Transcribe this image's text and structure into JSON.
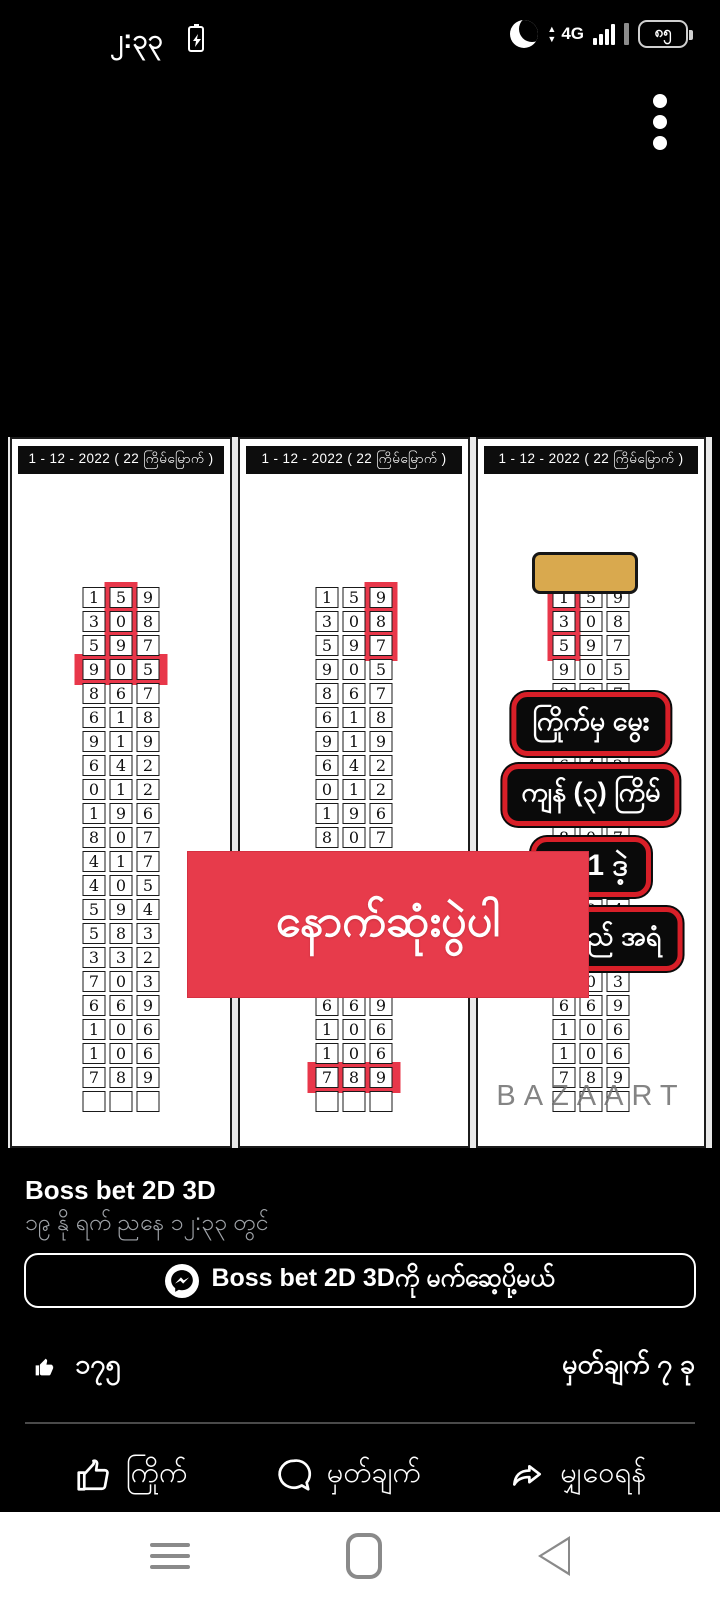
{
  "status_bar": {
    "time": "၂:၃၃",
    "network": "4G",
    "battery_percent": "၈၅",
    "charge_bolt": "⚡",
    "arrow_up": "▲",
    "arrow_down": "▼"
  },
  "lottery_image": {
    "banner_text": "နောက်ဆုံးပွဲပါ",
    "panel_header": "1 - 12 - 2022 ( 22 ကြိမ်မြောက် )",
    "watermark": "BAZAART",
    "badges": [
      "ကြိုက်မှ မွေး",
      "ကျန် (၃) ကြိမ်",
      "531 ဒဲ့",
      "ပတ်လည် အရံ"
    ],
    "grid_rows": [
      [
        "1",
        "5",
        "9"
      ],
      [
        "3",
        "0",
        "8"
      ],
      [
        "5",
        "9",
        "7"
      ],
      [
        "9",
        "0",
        "5"
      ],
      [
        "8",
        "6",
        "7"
      ],
      [
        "6",
        "1",
        "8"
      ],
      [
        "9",
        "1",
        "9"
      ],
      [
        "6",
        "4",
        "2"
      ],
      [
        "0",
        "1",
        "2"
      ],
      [
        "1",
        "9",
        "6"
      ],
      [
        "8",
        "0",
        "7"
      ],
      [
        "4",
        "1",
        "7"
      ],
      [
        "4",
        "0",
        "5"
      ],
      [
        "5",
        "9",
        "4"
      ],
      [
        "5",
        "8",
        "3"
      ],
      [
        "3",
        "3",
        "2"
      ],
      [
        "7",
        "0",
        "3"
      ],
      [
        "6",
        "6",
        "9"
      ],
      [
        "1",
        "0",
        "6"
      ],
      [
        "1",
        "0",
        "6"
      ],
      [
        "7",
        "8",
        "9"
      ],
      [
        "",
        "",
        ""
      ]
    ],
    "panels": [
      {
        "name": "left",
        "highlights": [
          {
            "type": "column",
            "col": 1,
            "row_start": 0,
            "row_end": 2
          },
          {
            "type": "row",
            "row": 3
          }
        ]
      },
      {
        "name": "center",
        "highlights": [
          {
            "type": "column",
            "col": 2,
            "row_start": 0,
            "row_end": 2
          },
          {
            "type": "row",
            "row": 20
          }
        ]
      },
      {
        "name": "right",
        "highlights": [
          {
            "type": "column",
            "col": 0,
            "row_start": 0,
            "row_end": 2
          }
        ]
      }
    ],
    "colors": {
      "banner_red": "#e73b4b",
      "badge_border_red": "#d81f28",
      "gold_tab": "#d9a94e",
      "highlight_red": "#e8374a"
    }
  },
  "post": {
    "page_name": "Boss bet 2D 3D",
    "timestamp": "၁၉ နို ရက် ညနေ ၁၂:၃၃ တွင်",
    "messenger_button_label": "Boss bet 2D 3Dကို မက်ဆေ့ပို့မယ်",
    "like_count": "၁၇၅",
    "comment_count_label": "မှတ်ချက် ၇ ခု",
    "like_color": "#1877f2",
    "actions": {
      "like": "ကြိုက်",
      "comment": "မှတ်ချက်",
      "share": "မျှဝေရန်"
    }
  }
}
